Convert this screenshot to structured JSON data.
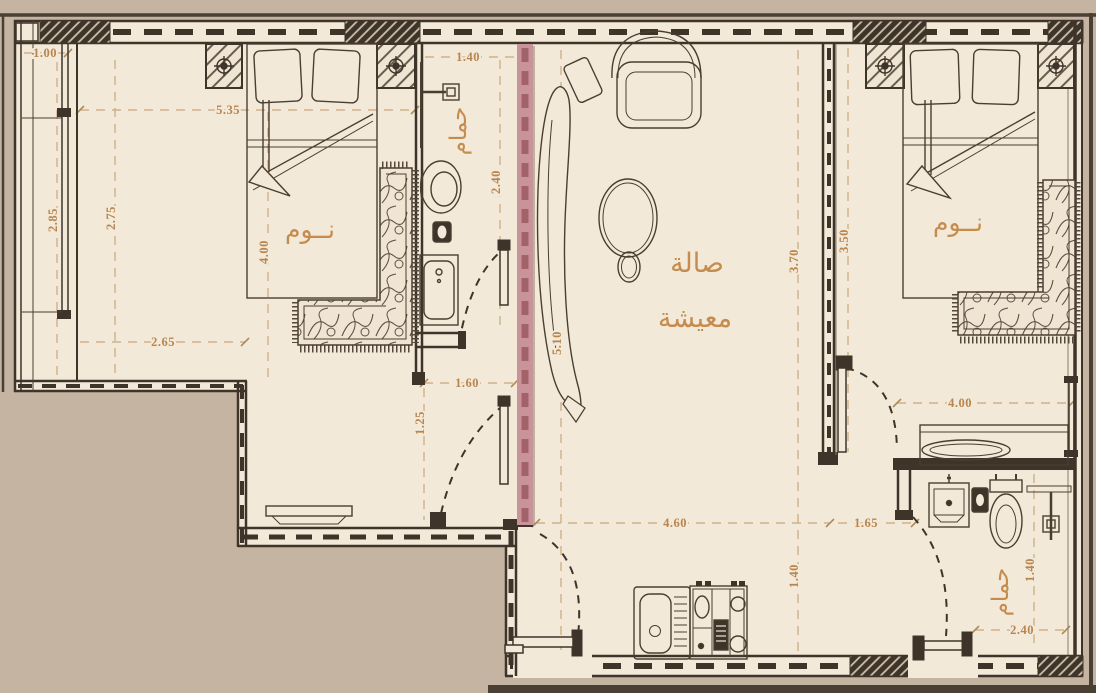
{
  "plan": {
    "rooms": {
      "bedroom_left": "نــوم",
      "bedroom_right": "نــوم",
      "bathroom_left": "حمام",
      "bathroom_right": "حمام",
      "living_line1": "صالة",
      "living_line2": "معيشة"
    },
    "dimensions": {
      "balcony_width": "1.00",
      "bedroom_left_width": "5.35",
      "balcony_depth": "2.85",
      "bedroom_left_depth": "2.75",
      "bedroom_left_inner_depth": "4.00",
      "entry_width": "2.65",
      "bathroom_left_width": "1.40",
      "bathroom_left_depth": "2.40",
      "hall_width": "1.60",
      "hall_depth": "1.25",
      "living_depth": "5.10",
      "living_east_depth": "3.70",
      "living_bottom_width": "4.60",
      "kitchen_offset_depth": "1.40",
      "bedroom_right_depth": "3.50",
      "vanity_width": "4.00",
      "bathroom_right_offset": "1.65",
      "bathroom_right_depth": "1.40",
      "bathroom_right_width": "2.40"
    },
    "colors": {
      "background": "#c6b4a2",
      "floor": "#f2e9d9",
      "wall": "#3e342a",
      "label_text": "#c68c4e",
      "dimension_text": "#b9854e",
      "highlight_wall": "#c99499",
      "highlight_wall_dash": "#a2626a"
    }
  }
}
